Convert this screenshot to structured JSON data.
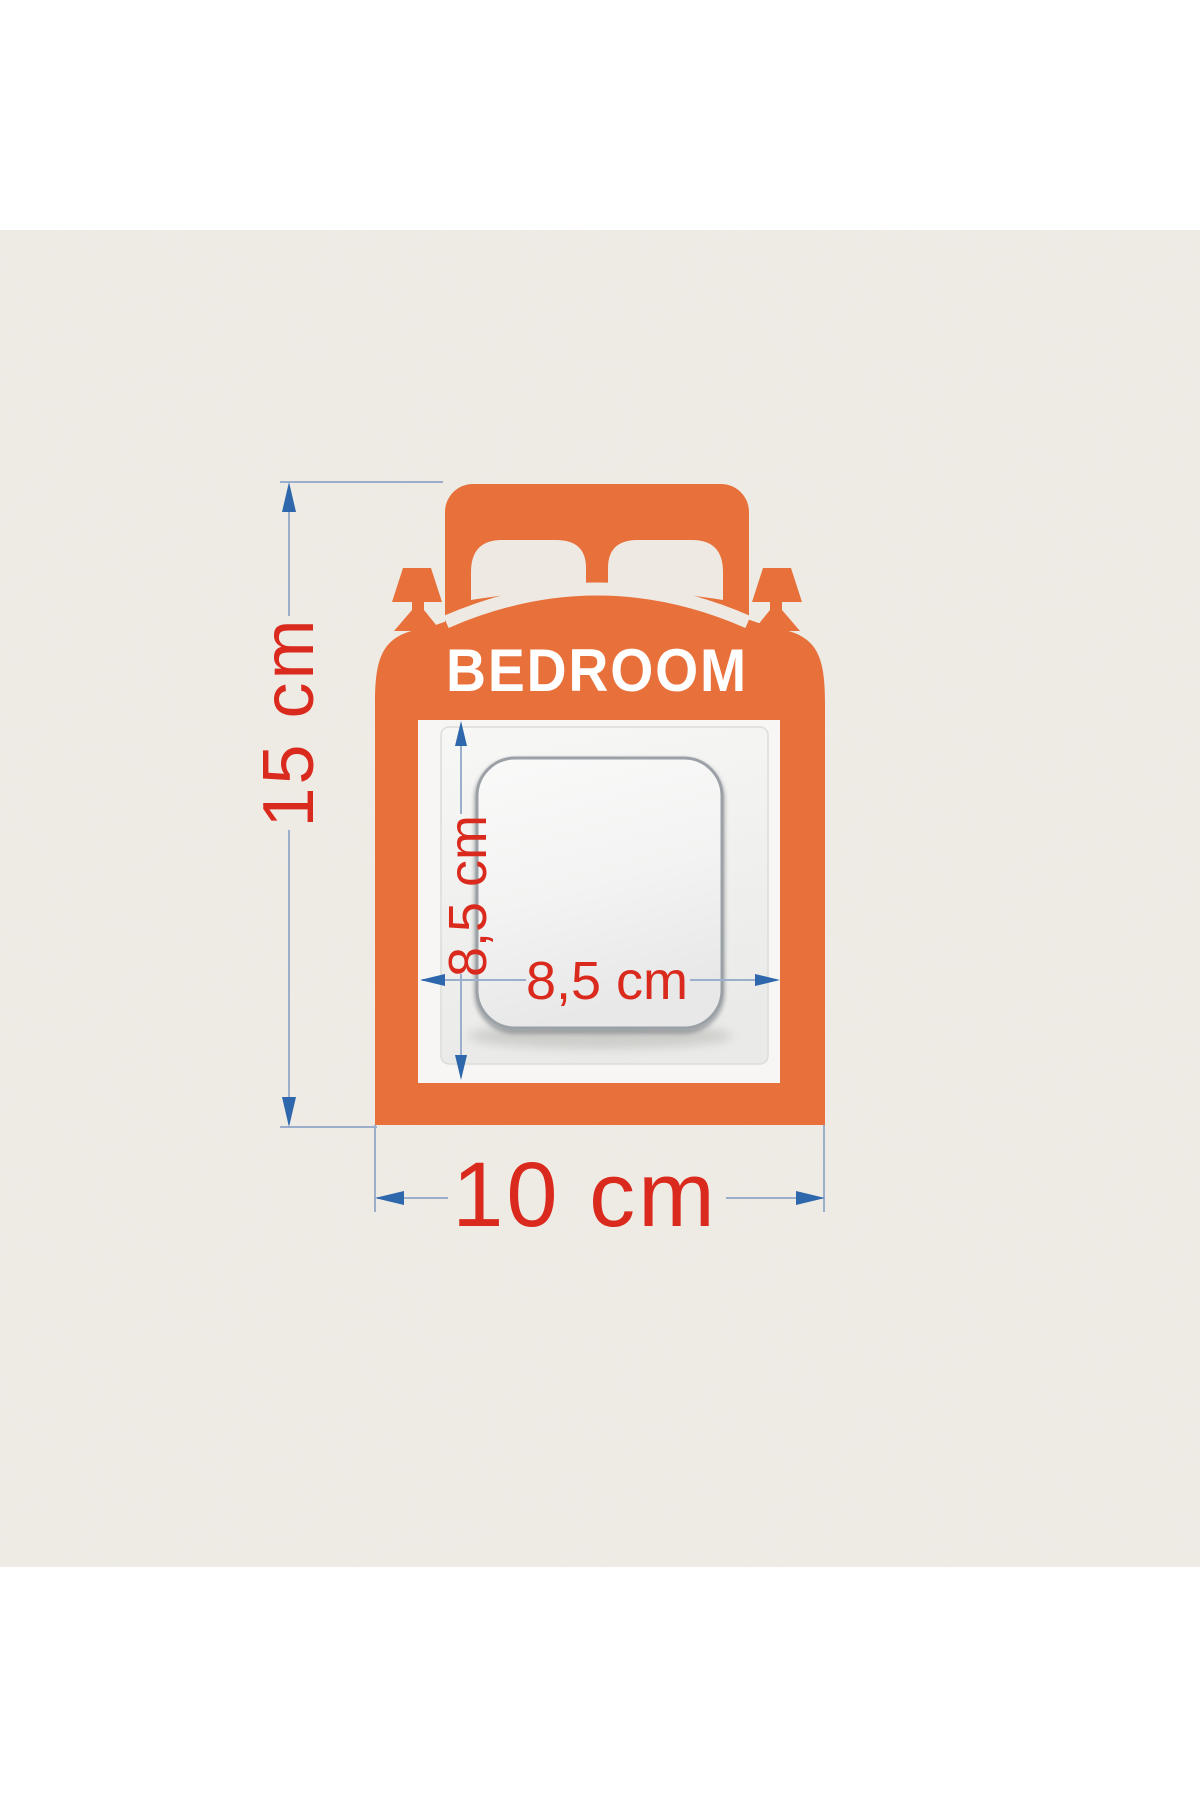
{
  "image": {
    "description": "Dimension diagram of a bed-shaped BEDROOM light switch wall sticker",
    "page_background": "#ffffff"
  },
  "wall": {
    "base_color": "#efeae3",
    "mottle_color": "#ddd6ca"
  },
  "sticker": {
    "label": "BEDROOM",
    "color": "#e8703a",
    "label_color": "#ffffff"
  },
  "dimensions": {
    "total_height": {
      "label": "15 cm"
    },
    "total_width": {
      "label": "10 cm"
    },
    "opening_height": {
      "label": "8,5 cm"
    },
    "opening_width": {
      "label": "8,5 cm"
    },
    "text_color": "#da2a1e",
    "line_color": "#9bafcd",
    "arrow_color": "#2e67ab"
  }
}
